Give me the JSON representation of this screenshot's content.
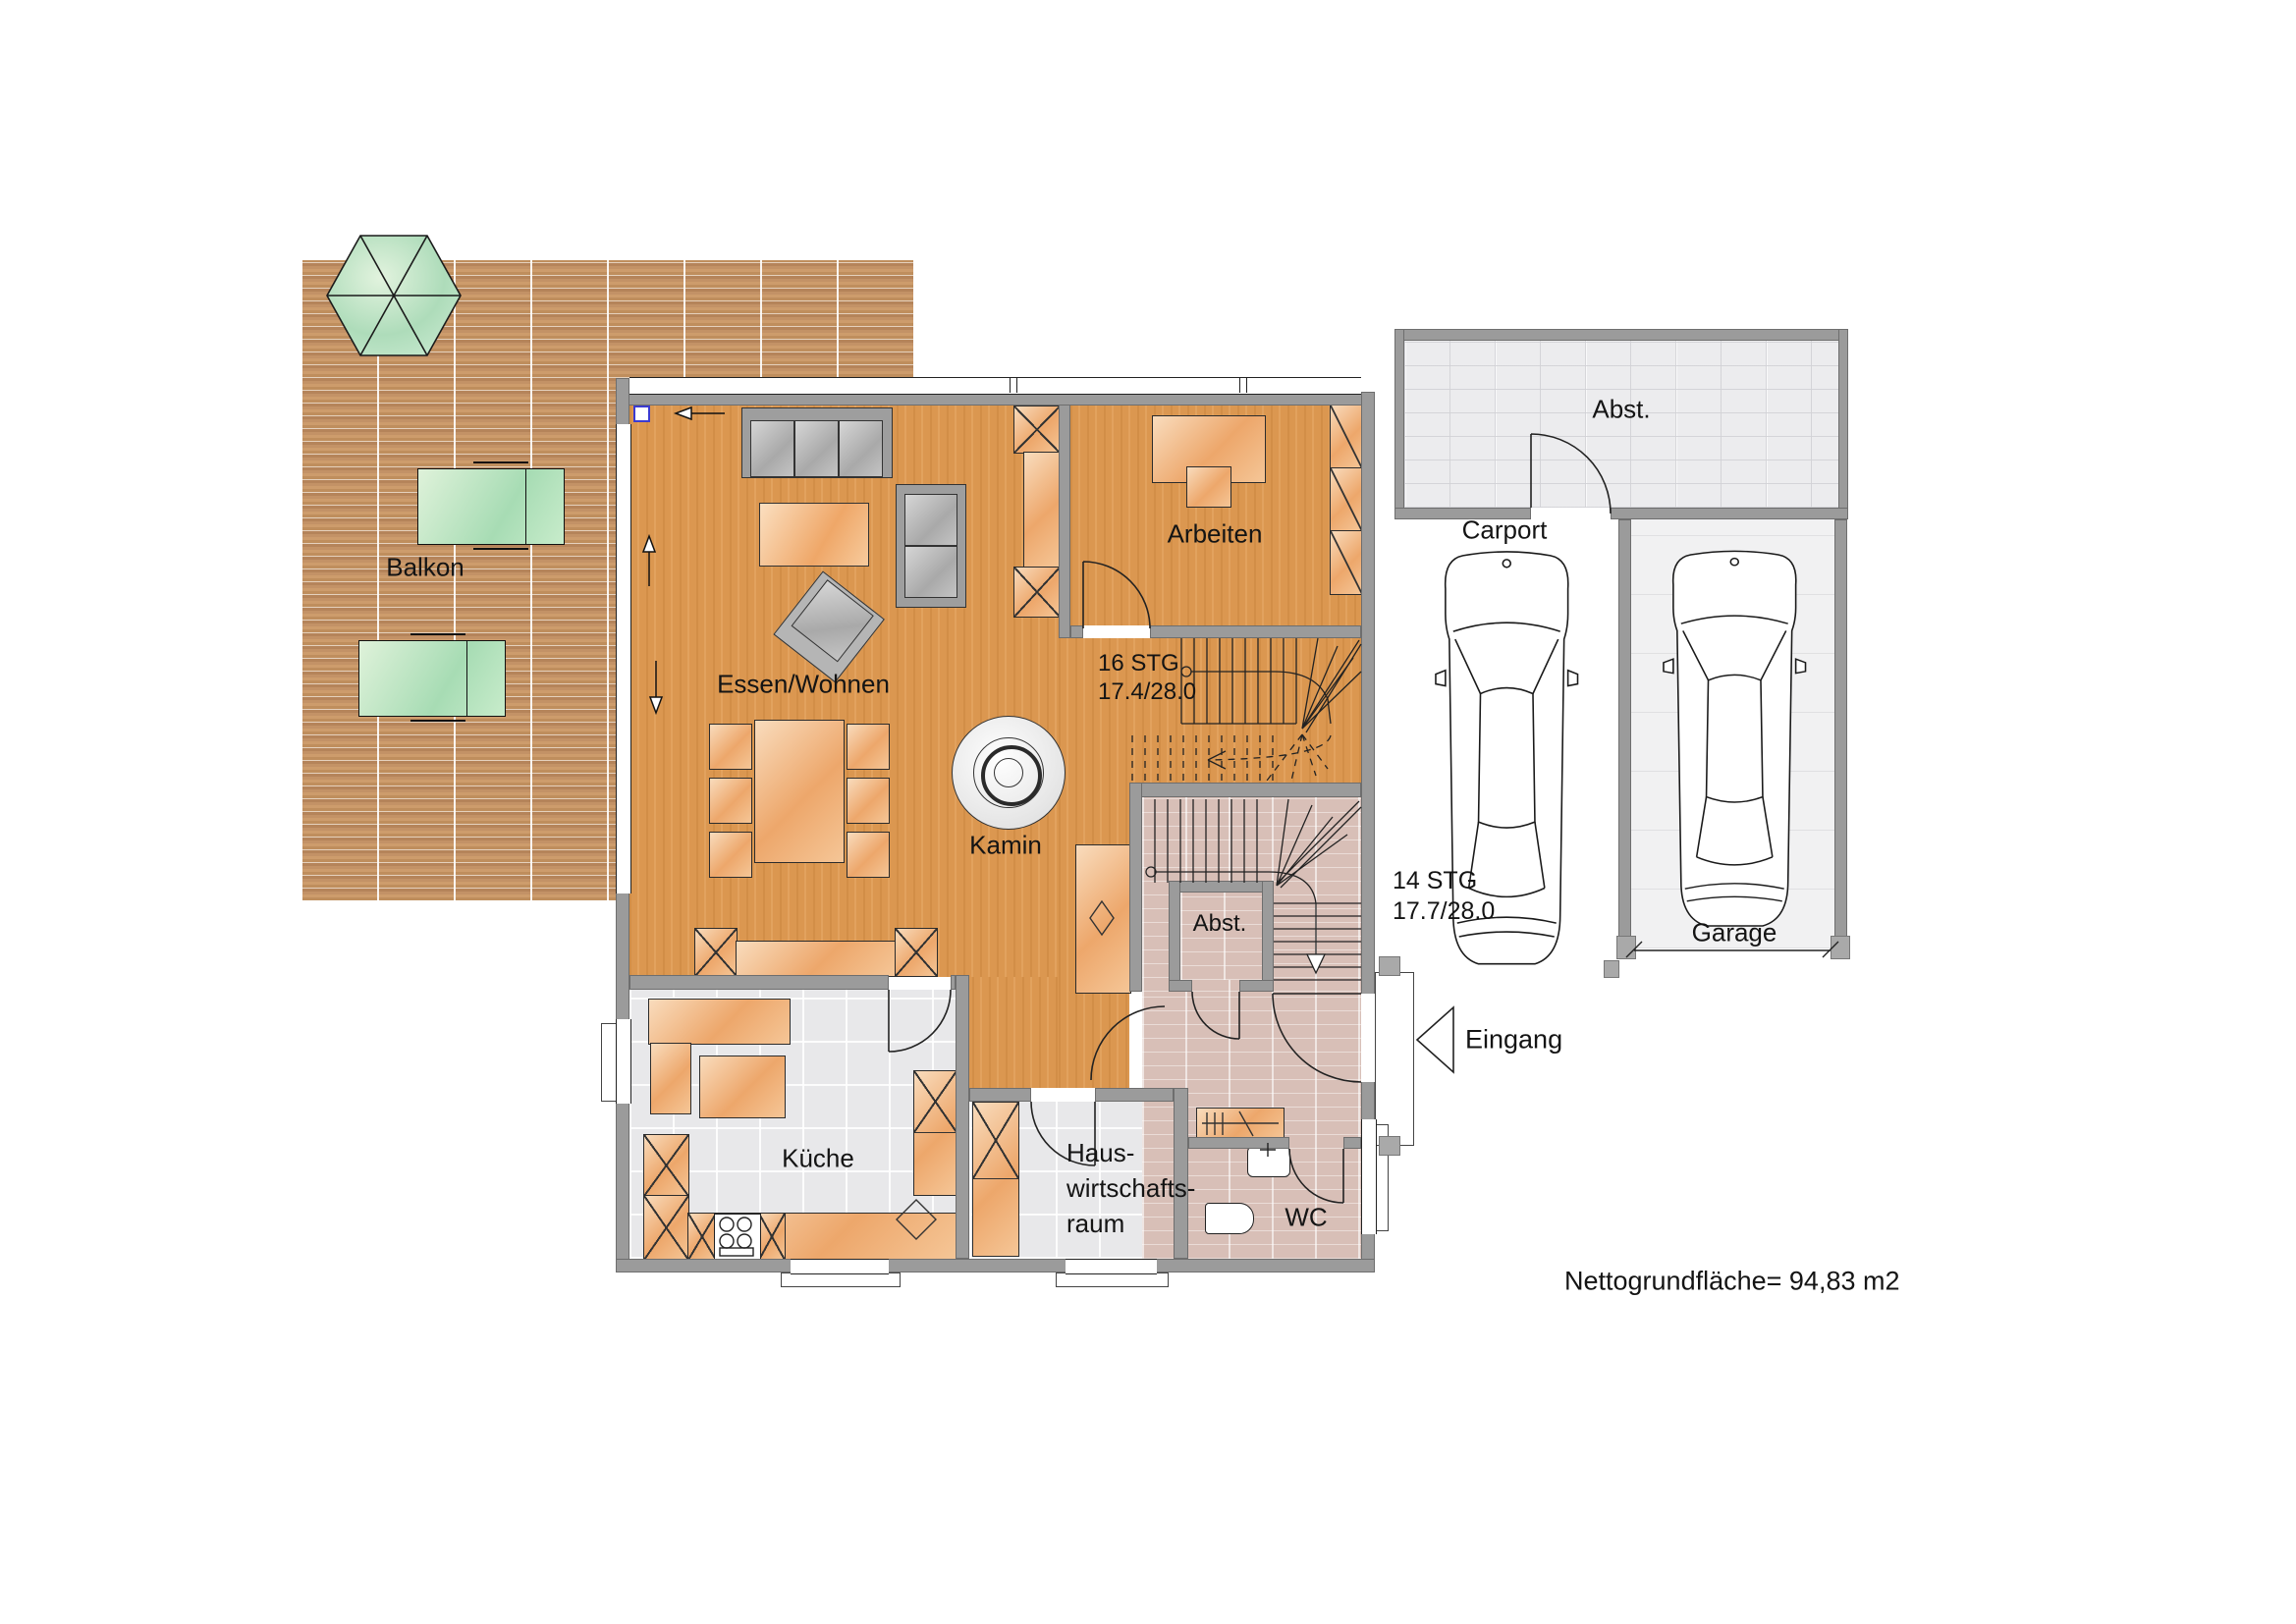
{
  "labels": {
    "balkon": "Balkon",
    "essen_wohnen": "Essen/Wohnen",
    "kamin": "Kamin",
    "arbeiten": "Arbeiten",
    "kueche": "Küche",
    "hwr1": "Haus-",
    "hwr2": "wirtschafts-",
    "hwr3": "raum",
    "wc": "WC",
    "abst_innen": "Abst.",
    "abst_aussen": "Abst.",
    "carport": "Carport",
    "garage": "Garage",
    "eingang": "Eingang",
    "nettogrundflaeche": "Nettogrundfläche= 94,83 m2"
  },
  "stairs": {
    "upper": {
      "steps": "16 STG",
      "dims": "17.4/28.0"
    },
    "lower": {
      "steps": "14 STG",
      "dims": "17.7/28.0"
    }
  },
  "colors": {
    "wood_floor": "#db9750",
    "deck": "#c6996c",
    "tile": "#e8e8ea",
    "hall_tile": "#d8bfb7",
    "wall": "#9b9b9b",
    "furniture_orange": "#eda76b",
    "furniture_green": "#a7dcb4",
    "marker_blue": "#3b3bd0"
  }
}
